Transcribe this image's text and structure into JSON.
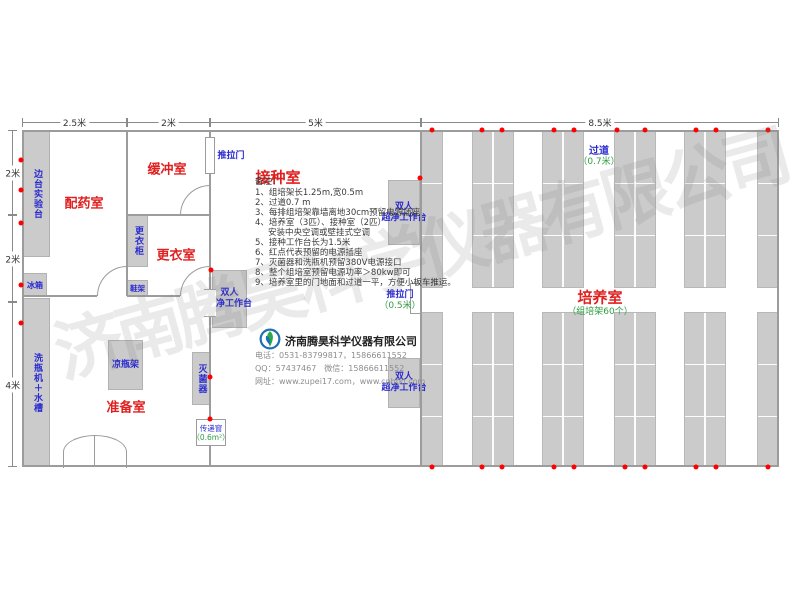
{
  "watermark": {
    "text": "济南腾昊科学仪器有限公司"
  },
  "dimensions": {
    "top": [
      "2.5米",
      "2米",
      "5米",
      "8.5米"
    ],
    "left": [
      "2米",
      "2米",
      "4米"
    ]
  },
  "rooms": {
    "dispensing": "配药室",
    "buffer": "缓冲室",
    "changing": "更衣室",
    "inoculation": "接种室",
    "preparation": "准备室",
    "culture": "培养室",
    "culture_sub": "（组培架60个）"
  },
  "corridor": {
    "label": "过道",
    "size": "（0.7米）"
  },
  "doors": {
    "slide_top": "推拉门",
    "slide_right": "推拉门",
    "slide_right_size": "（0.5米）",
    "pass_window": "传递窗",
    "pass_window_size": "（0.6m²）"
  },
  "equipment": {
    "side_bench": "边台实验台",
    "fridge": "冰箱",
    "bottle_washer": "洗瓶机＋水槽",
    "wardrobe": "更衣柜",
    "shoe_rack": "鞋架",
    "bottle_rack": "凉瓶架",
    "sterilizer": "灭菌器",
    "bench_line1": "双人",
    "bench_line2": "超净工作台"
  },
  "notes": {
    "title": "备注：",
    "items": [
      "1、组培架长1.25m,宽0.5m",
      "2、过道0.7 m",
      "3、每排组培架靠墙离地30cm预留电源插座",
      "4、培养室（3匹）、接种室（2匹）",
      "安装中央空调或壁挂式空调",
      "5、接种工作台长为1.5米",
      "6、红点代表预留的电源插座",
      "7、灭菌器和洗瓶机预留380V电源接口",
      "8、整个组培室预留电源功率＞80kw即可",
      "9、培养室里的门地面和过道一平，方便小板车推运。"
    ]
  },
  "company": {
    "name": "济南腾昊科学仪器有限公司",
    "phone": "电话：0531-83799817，15866611552",
    "qq_wechat": "QQ：57437467　微信：15866611552",
    "website": "网址：www.zupei17.com，www.cnhtkj.com"
  },
  "colors": {
    "room_label": "#e01f1f",
    "equipment_label": "#2b2bd0",
    "size_label": "#2f9e44",
    "outlet_dot": "#ff0000",
    "box_fill": "#cbcbcb",
    "wall": "#9c9c9c"
  },
  "floorplan": {
    "racks": [
      {
        "x": 421,
        "w": 22,
        "double": false
      },
      {
        "x": 472,
        "w": 42,
        "double": true
      },
      {
        "x": 542,
        "w": 42,
        "double": true
      },
      {
        "x": 614,
        "w": 42,
        "double": true
      },
      {
        "x": 684,
        "w": 42,
        "double": true
      },
      {
        "x": 757,
        "w": 22,
        "double": false
      }
    ],
    "outlets": [
      [
        21,
        160
      ],
      [
        21,
        190
      ],
      [
        21,
        223
      ],
      [
        21,
        285
      ],
      [
        21,
        323
      ],
      [
        211,
        270
      ],
      [
        210,
        377
      ],
      [
        210,
        419
      ],
      [
        420,
        178
      ],
      [
        432,
        130
      ],
      [
        482,
        130
      ],
      [
        502,
        130
      ],
      [
        554,
        130
      ],
      [
        574,
        130
      ],
      [
        617,
        130
      ],
      [
        645,
        130
      ],
      [
        696,
        130
      ],
      [
        716,
        130
      ],
      [
        768,
        130
      ],
      [
        432,
        467
      ],
      [
        482,
        467
      ],
      [
        502,
        467
      ],
      [
        554,
        467
      ],
      [
        574,
        467
      ],
      [
        625,
        467
      ],
      [
        645,
        467
      ],
      [
        696,
        467
      ],
      [
        716,
        467
      ],
      [
        768,
        467
      ]
    ]
  }
}
